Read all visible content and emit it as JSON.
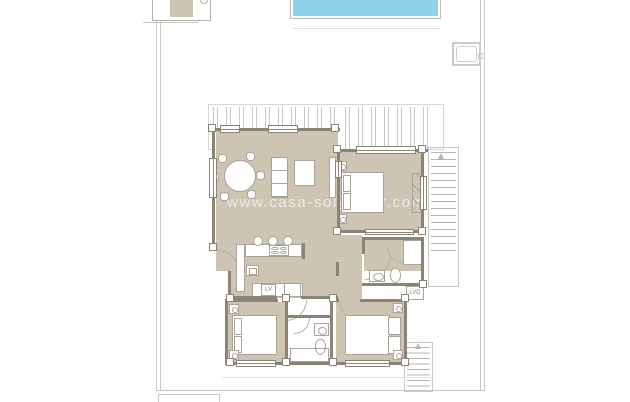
{
  "watermark": {
    "text": "www.casa-solyamar.com"
  },
  "labels": {
    "dishwasher": "LV",
    "laundry_closet": "LVD"
  },
  "colors": {
    "floor": "#cec4b4",
    "wall": "#8a8477",
    "furniture_line": "#a9a399",
    "site_line": "#c9c7c3",
    "pergola_line": "#cbc8c2",
    "stair_line": "#b7b4ae",
    "door_line": "#b3aea4",
    "pool_fill": "#8fd1e8",
    "pool_border": "#bcbcbc",
    "watermark_color": "rgba(255,255,255,0.65)"
  }
}
